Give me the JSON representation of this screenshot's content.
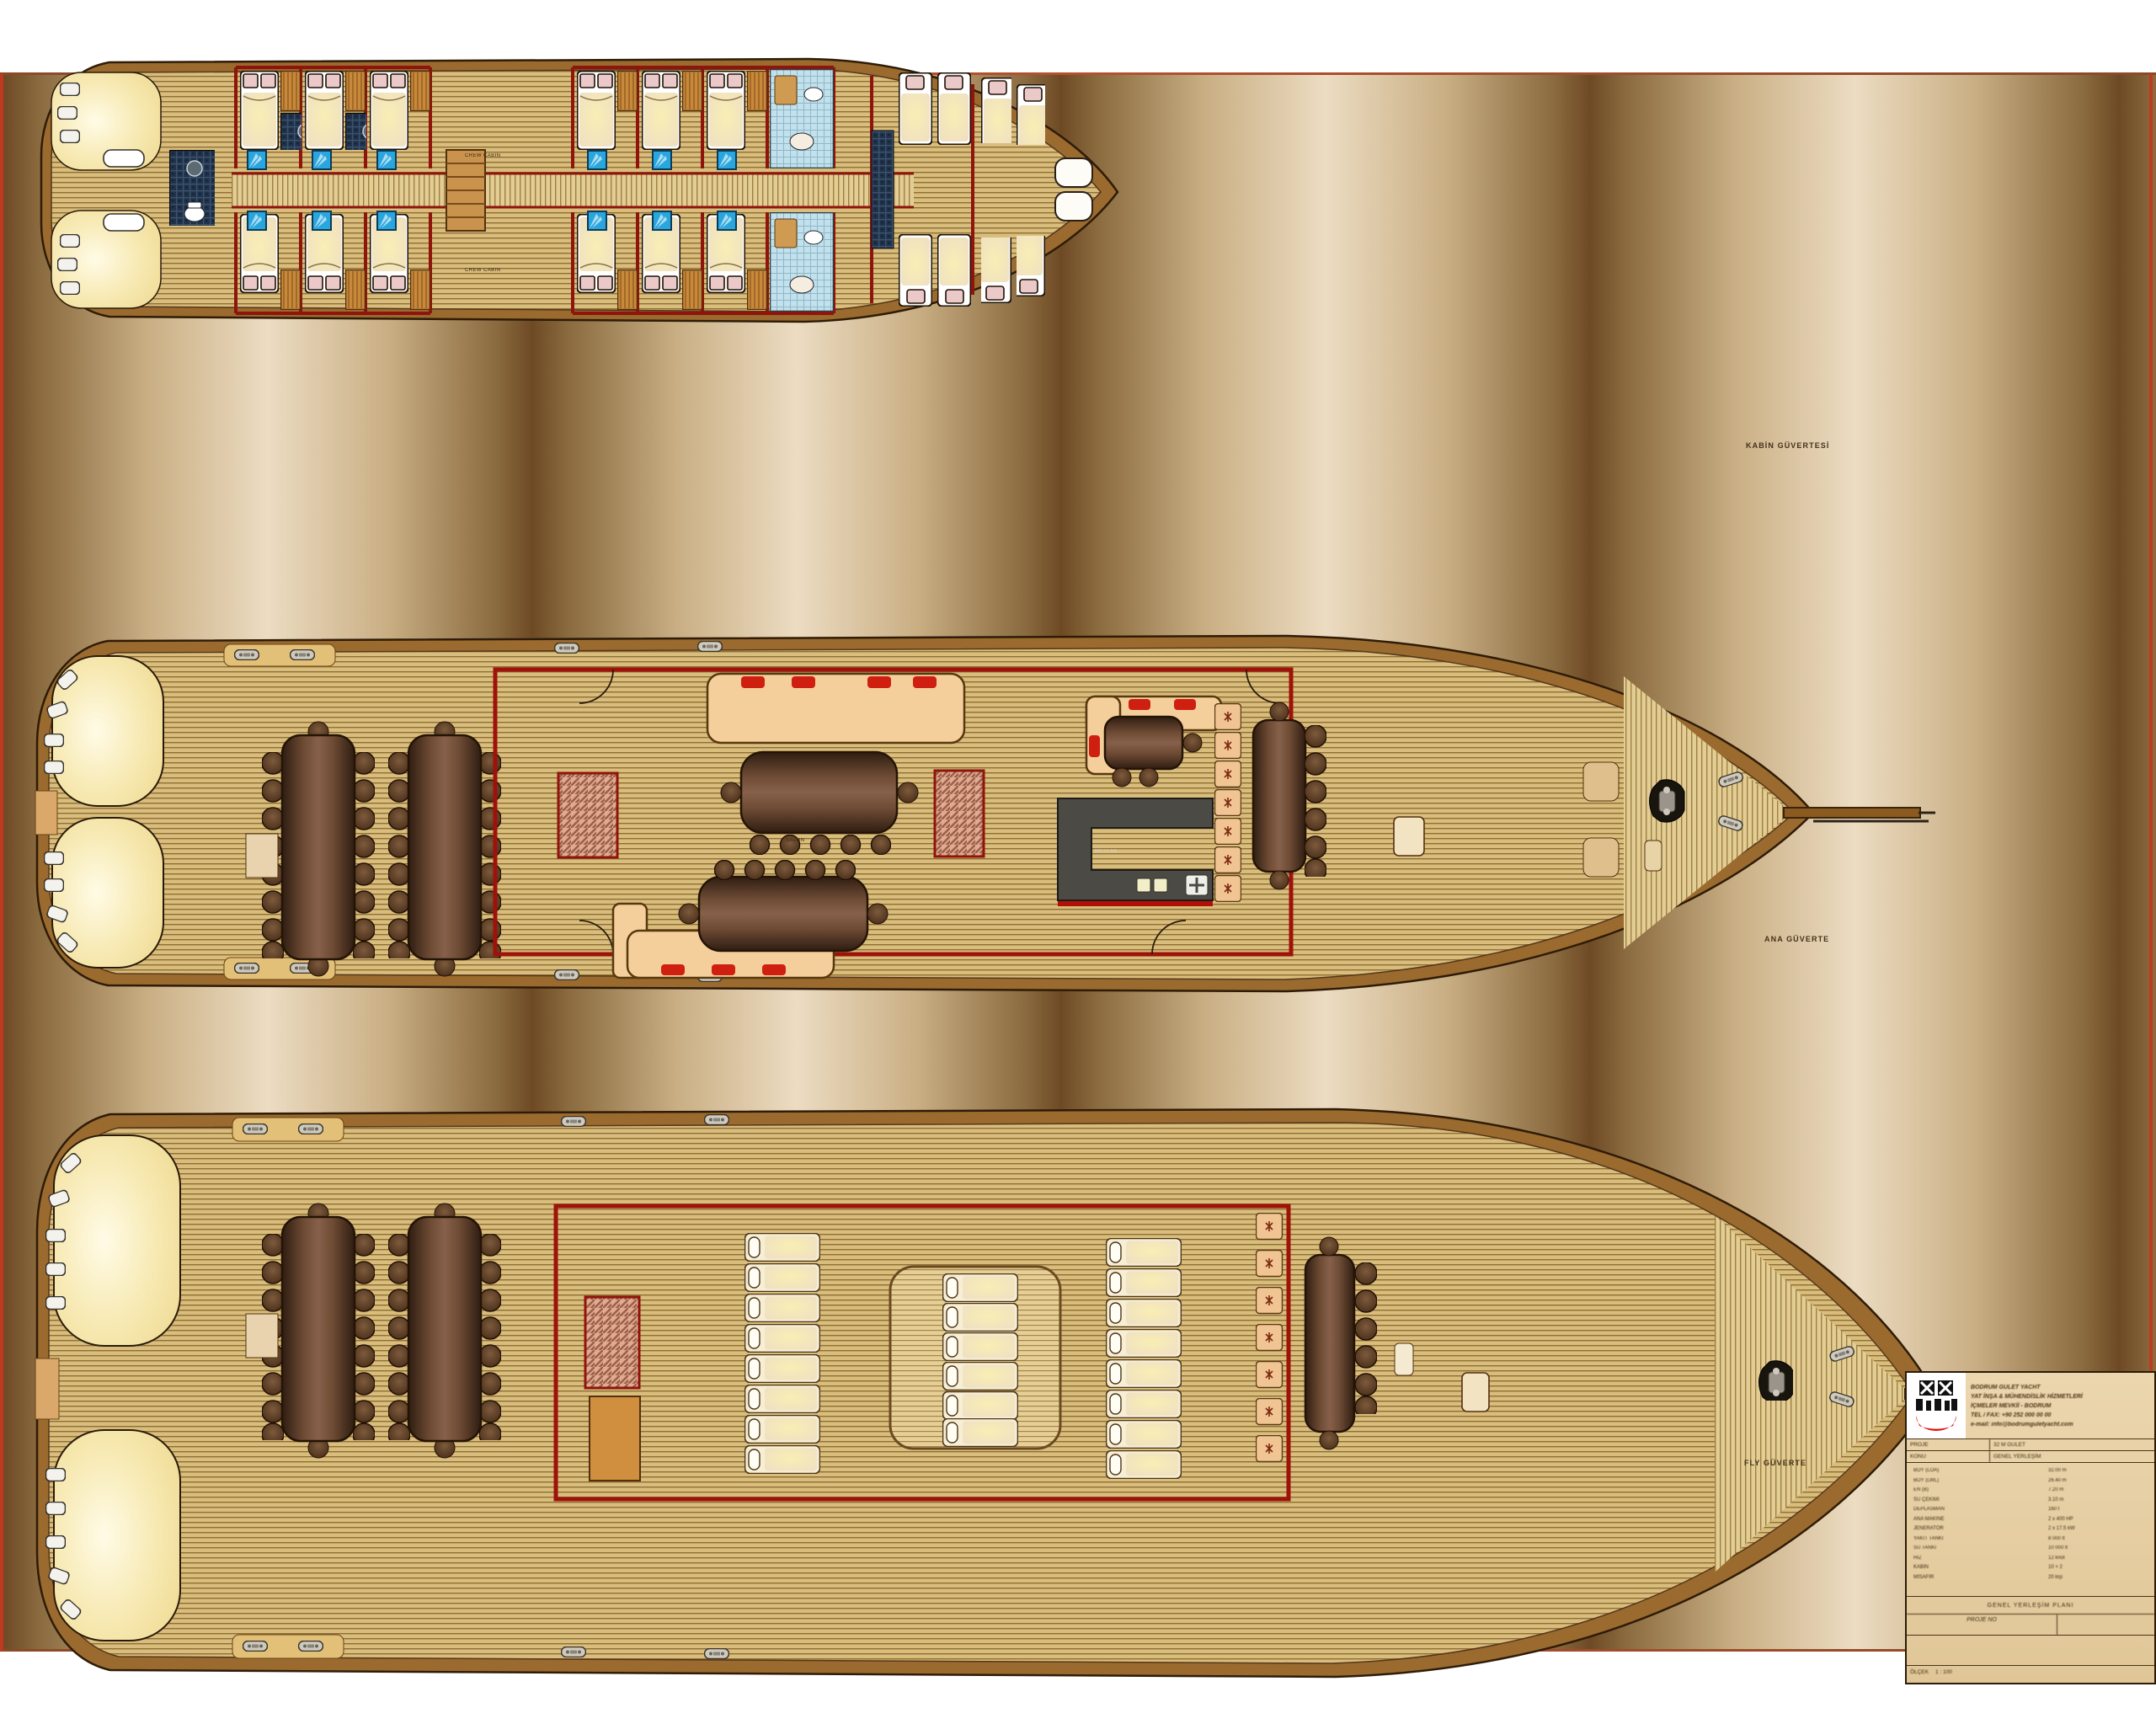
{
  "sheet": {
    "background_light": "#ecdcc2",
    "background_dark": "#6e4a24",
    "border_red": "#c03a20",
    "hull_brown": "#9a6a2e",
    "deck_plank": "#d9bd7d",
    "wall_red": "#9e120a",
    "skylight_blue": "#2aa6df",
    "galley_gray": "#4c4a45"
  },
  "decks": {
    "deck1": {
      "label": "KABİN GÜVERTESİ"
    },
    "deck2": {
      "label": "ANA GÜVERTE"
    },
    "deck3": {
      "label": "FLY GÜVERTE"
    }
  },
  "annotations": {
    "crew_cabin": "CREW CABIN",
    "salon": "SALON",
    "galley": "MUTFAK"
  },
  "title_block": {
    "company_lines": [
      "BODRUM GULET YACHT",
      "YAT İNŞA & MÜHENDİSLİK HİZMETLERİ",
      "İÇMELER MEVKİİ - BODRUM",
      "TEL / FAX: +90 252 000 00 00",
      "e-mail: info@bodrumguletyacht.com"
    ],
    "project_row": {
      "left": "PROJE",
      "right": "32 M GULET"
    },
    "subject_row": {
      "left": "KONU",
      "right": "GENEL YERLEŞİM"
    },
    "specs": [
      {
        "label": "BOY (LOA)",
        "value": "32.00 m"
      },
      {
        "label": "BOY (LWL)",
        "value": "26.40 m"
      },
      {
        "label": "EN (B)",
        "value": "7.20 m"
      },
      {
        "label": "SU ÇEKİMİ",
        "value": "3.10 m"
      },
      {
        "label": "DEPLASMAN",
        "value": "160 t"
      },
      {
        "label": "ANA MAKİNE",
        "value": "2 x 400 HP"
      },
      {
        "label": "JENERATÖR",
        "value": "2 x 17.5 kW"
      },
      {
        "label": "YAKIT TANKI",
        "value": "8 000 lt"
      },
      {
        "label": "SU TANKI",
        "value": "10 000 lt"
      },
      {
        "label": "HIZ",
        "value": "12 knot"
      },
      {
        "label": "KABİN",
        "value": "10 + 2"
      },
      {
        "label": "MİSAFİR",
        "value": "20 kişi"
      }
    ],
    "caption": "GENEL YERLEŞİM PLANI",
    "project_no_label": "PROJE NO",
    "scale_label": "ÖLÇEK",
    "scale_value": "1 : 100"
  }
}
